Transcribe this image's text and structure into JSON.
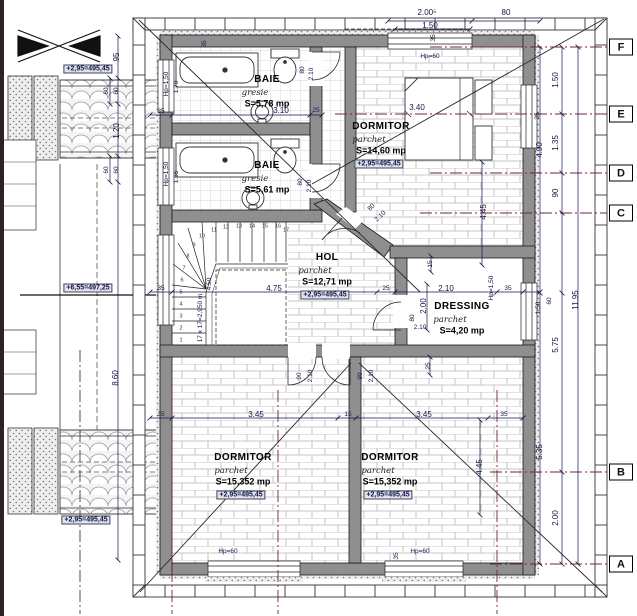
{
  "drawing": {
    "rooms": [
      {
        "id": "baie-1",
        "name": "BAIE",
        "finish": "gresie",
        "area": "S=5,78 mp",
        "x": 267,
        "y": 80
      },
      {
        "id": "baie-2",
        "name": "BAIE",
        "finish": "gresie",
        "area": "S=5,61 mp",
        "x": 267,
        "y": 166
      },
      {
        "id": "dormitor-top",
        "name": "DORMITOR",
        "finish": "parchet",
        "area": "S=14,60 mp",
        "level": "+2,95=495,45",
        "x": 381,
        "y": 127
      },
      {
        "id": "hol",
        "name": "HOL",
        "finish": "parchet",
        "area": "S=12,71 mp",
        "level": "+2,95=495,45",
        "x": 327,
        "y": 258
      },
      {
        "id": "dressing",
        "name": "DRESSING",
        "finish": "parchet",
        "area": "S=4,20 mp",
        "x": 462,
        "y": 307
      },
      {
        "id": "dormitor-left",
        "name": "DORMITOR",
        "finish": "parchet",
        "area": "S=15,352 mp",
        "level": "+2,95=495,45",
        "x": 243,
        "y": 458
      },
      {
        "id": "dormitor-right",
        "name": "DORMITOR",
        "finish": "parchet",
        "area": "S=15,352 mp",
        "level": "+2,95=495,45",
        "x": 390,
        "y": 458
      }
    ],
    "stairs": {
      "note": "17 x 17=2,950 m",
      "steps": [
        {
          "n": "1",
          "x": 181,
          "y": 341
        },
        {
          "n": "2",
          "x": 181,
          "y": 329
        },
        {
          "n": "3",
          "x": 181,
          "y": 317
        },
        {
          "n": "4",
          "x": 181,
          "y": 305
        },
        {
          "n": "5",
          "x": 181,
          "y": 293
        },
        {
          "n": "6",
          "x": 182,
          "y": 281
        },
        {
          "n": "7",
          "x": 184,
          "y": 269
        },
        {
          "n": "8",
          "x": 188,
          "y": 257
        },
        {
          "n": "9",
          "x": 194,
          "y": 246
        },
        {
          "n": "10",
          "x": 202,
          "y": 237
        },
        {
          "n": "11",
          "x": 214,
          "y": 231
        },
        {
          "n": "12",
          "x": 226,
          "y": 228
        },
        {
          "n": "13",
          "x": 239,
          "y": 227
        },
        {
          "n": "14",
          "x": 252,
          "y": 227
        },
        {
          "n": "15",
          "x": 265,
          "y": 227
        },
        {
          "n": "16",
          "x": 278,
          "y": 227
        },
        {
          "n": "17",
          "x": 286,
          "y": 231
        }
      ]
    },
    "grid_axes": [
      {
        "label": "F",
        "y": 47
      },
      {
        "label": "E",
        "y": 114
      },
      {
        "label": "D",
        "y": 173
      },
      {
        "label": "C",
        "y": 213
      },
      {
        "label": "B",
        "y": 472
      },
      {
        "label": "A",
        "y": 564
      }
    ],
    "labels": [
      {
        "t": "2.00⁵",
        "x": 427,
        "y": 13,
        "c": "dim",
        "n": "dim-top-200"
      },
      {
        "t": "80",
        "x": 506,
        "y": 13,
        "c": "dim",
        "n": "dim-top-80"
      },
      {
        "t": "1.50",
        "x": 430,
        "y": 26,
        "c": "dim",
        "n": "dim-top-150"
      },
      {
        "t": "35",
        "x": 434,
        "y": 38,
        "r": -90,
        "c": "dim7",
        "n": "dim-top-35"
      },
      {
        "t": "Hp=60",
        "x": 430,
        "y": 57,
        "c": "dim7",
        "n": "parapet-top-window"
      },
      {
        "t": "35",
        "x": 205,
        "y": 44,
        "r": -90,
        "c": "dim7",
        "n": "dim-topwall-35"
      },
      {
        "t": "95",
        "x": 117,
        "y": 57,
        "r": -90,
        "c": "dim",
        "n": "dim-left-95"
      },
      {
        "t": "60",
        "x": 107,
        "y": 91,
        "r": -90,
        "c": "dim7",
        "n": "dim-left-60a"
      },
      {
        "t": "60",
        "x": 117,
        "y": 91,
        "r": -90,
        "c": "dim7",
        "n": "dim-left-60b"
      },
      {
        "t": "1.20",
        "x": 117,
        "y": 131,
        "r": -90,
        "c": "dim",
        "n": "dim-left-120"
      },
      {
        "t": "60",
        "x": 107,
        "y": 170,
        "r": -90,
        "c": "dim7",
        "n": "dim-left-60c"
      },
      {
        "t": "60",
        "x": 117,
        "y": 170,
        "r": -90,
        "c": "dim7",
        "n": "dim-left-60d"
      },
      {
        "t": "8.60",
        "x": 116,
        "y": 378,
        "r": -90,
        "c": "dim",
        "n": "dim-left-860"
      },
      {
        "t": "+2,95=495,45",
        "x": 88,
        "y": 69,
        "c": "lvl",
        "n": "level-left-top"
      },
      {
        "t": "+6,55=497,25",
        "x": 88,
        "y": 288,
        "c": "lvl",
        "n": "level-left-mid"
      },
      {
        "t": "+2,95=495,45",
        "x": 86,
        "y": 520,
        "c": "lvl",
        "n": "level-left-bottom"
      },
      {
        "t": "Hp=1,50",
        "x": 167,
        "y": 84,
        "r": -90,
        "c": "dim7",
        "n": "parapet-baie1-window"
      },
      {
        "t": "1.70",
        "x": 177,
        "y": 87,
        "r": -90,
        "c": "dim7",
        "n": "dim-win-170"
      },
      {
        "t": "Hp=1,50",
        "x": 167,
        "y": 174,
        "r": -90,
        "c": "dim7",
        "n": "parapet-baie2-window"
      },
      {
        "t": "1.65",
        "x": 177,
        "y": 177,
        "r": -90,
        "c": "dim7",
        "n": "dim-win-165"
      },
      {
        "t": "35",
        "x": 161,
        "y": 112,
        "c": "dim7",
        "n": "dim-baie-35"
      },
      {
        "t": "3.10",
        "x": 281,
        "y": 111,
        "c": "dim",
        "n": "dim-baie-310"
      },
      {
        "t": "25",
        "x": 316,
        "y": 111,
        "c": "dim7",
        "n": "dim-baie-25"
      },
      {
        "t": "80",
        "x": 303,
        "y": 70,
        "r": -90,
        "c": "dim7",
        "n": "door-baie1-80"
      },
      {
        "t": "2.10",
        "x": 312,
        "y": 74,
        "r": -90,
        "c": "dim7",
        "n": "door-baie1-210"
      },
      {
        "t": "80",
        "x": 301,
        "y": 182,
        "r": -90,
        "c": "dim7",
        "n": "door-baie2-80"
      },
      {
        "t": "2.10",
        "x": 310,
        "y": 186,
        "r": -90,
        "c": "dim7",
        "n": "door-baie2-210"
      },
      {
        "t": "3.40",
        "x": 417,
        "y": 108,
        "c": "dim",
        "n": "dim-bed-340"
      },
      {
        "t": "4.45",
        "x": 484,
        "y": 212,
        "r": -90,
        "c": "dim",
        "n": "dim-dorm-445"
      },
      {
        "t": "35",
        "x": 538,
        "y": 116,
        "r": -90,
        "c": "dim7",
        "n": "dim-rightwall-35"
      },
      {
        "t": "80",
        "x": 372,
        "y": 208,
        "r": -45,
        "c": "dim7",
        "n": "door-diag-80"
      },
      {
        "t": "2.10",
        "x": 381,
        "y": 217,
        "r": -45,
        "c": "dim7",
        "n": "door-diag-210"
      },
      {
        "t": "4.75",
        "x": 274,
        "y": 289,
        "c": "dim",
        "n": "dim-hol-475"
      },
      {
        "t": "35",
        "x": 161,
        "y": 289,
        "c": "dim7",
        "n": "dim-hol-35l"
      },
      {
        "t": "25",
        "x": 386,
        "y": 289,
        "c": "dim7",
        "n": "dim-hol-25"
      },
      {
        "t": "2.10",
        "x": 446,
        "y": 289,
        "c": "dim",
        "n": "dim-dressing-210"
      },
      {
        "t": "35",
        "x": 508,
        "y": 289,
        "c": "dim7",
        "n": "dim-hol-35r"
      },
      {
        "t": "15",
        "x": 431,
        "y": 264,
        "r": -90,
        "c": "dim7",
        "n": "dim-dressing-15"
      },
      {
        "t": "2.00",
        "x": 424,
        "y": 306,
        "r": -90,
        "c": "dim",
        "n": "dim-dressing-200"
      },
      {
        "t": "Hp=1,50",
        "x": 492,
        "y": 288,
        "r": -90,
        "c": "dim7",
        "n": "parapet-dressing-window"
      },
      {
        "t": "25",
        "x": 429,
        "y": 366,
        "r": -90,
        "c": "dim7",
        "n": "dim-dressing-25"
      },
      {
        "t": "80",
        "x": 413,
        "y": 318,
        "r": -90,
        "c": "dim7",
        "n": "door-dressing-80"
      },
      {
        "t": "2.10",
        "x": 420,
        "y": 328,
        "c": "dim7",
        "n": "door-dressing-210"
      },
      {
        "t": "90",
        "x": 300,
        "y": 376,
        "r": -90,
        "c": "dim7",
        "n": "door-bedl-90"
      },
      {
        "t": "2.10",
        "x": 311,
        "y": 376,
        "r": -90,
        "c": "dim7",
        "n": "door-bedl-210"
      },
      {
        "t": "90",
        "x": 361,
        "y": 376,
        "r": -90,
        "c": "dim7",
        "n": "door-bedr-90"
      },
      {
        "t": "2.10",
        "x": 372,
        "y": 376,
        "r": -90,
        "c": "dim7",
        "n": "door-bedr-210"
      },
      {
        "t": "4.50",
        "x": 210,
        "y": 284,
        "r": -90,
        "c": "dim7",
        "n": "dim-stair-450"
      },
      {
        "t": "35",
        "x": 161,
        "y": 415,
        "c": "dim7",
        "n": "dim-bed-35l"
      },
      {
        "t": "3.45",
        "x": 256,
        "y": 415,
        "c": "dim",
        "n": "dim-bed-345l"
      },
      {
        "t": "15",
        "x": 348,
        "y": 415,
        "c": "dim7",
        "n": "dim-bed-15"
      },
      {
        "t": "3.45",
        "x": 424,
        "y": 415,
        "c": "dim",
        "n": "dim-bed-345r"
      },
      {
        "t": "35",
        "x": 504,
        "y": 415,
        "c": "dim7",
        "n": "dim-bed-35r"
      },
      {
        "t": "Hp=60",
        "x": 228,
        "y": 552,
        "c": "dim7",
        "n": "parapet-bedl-window"
      },
      {
        "t": "Hp=60",
        "x": 420,
        "y": 552,
        "c": "dim7",
        "n": "parapet-bedr-window"
      },
      {
        "t": "35",
        "x": 397,
        "y": 556,
        "r": -90,
        "c": "dim7",
        "n": "dim-bottom-35"
      },
      {
        "t": "4.45",
        "x": 480,
        "y": 467,
        "r": -90,
        "c": "dim",
        "n": "dim-bedr-445"
      },
      {
        "t": "1.50",
        "x": 556,
        "y": 80,
        "r": -90,
        "c": "dim",
        "n": "dim-right-150a"
      },
      {
        "t": "1.35",
        "x": 556,
        "y": 143,
        "r": -90,
        "c": "dim",
        "n": "dim-right-135"
      },
      {
        "t": "90",
        "x": 556,
        "y": 193,
        "r": -90,
        "c": "dim",
        "n": "dim-right-90"
      },
      {
        "t": "4.90",
        "x": 540,
        "y": 150,
        "r": -90,
        "c": "dim",
        "n": "dim-right-490"
      },
      {
        "t": "1.50",
        "x": 539,
        "y": 308,
        "r": -90,
        "c": "dim7",
        "n": "dim-right-150b"
      },
      {
        "t": "60",
        "x": 550,
        "y": 301,
        "r": -90,
        "c": "dim7",
        "n": "dim-right-60"
      },
      {
        "t": "5.75",
        "x": 556,
        "y": 345,
        "r": -90,
        "c": "dim",
        "n": "dim-right-575"
      },
      {
        "t": "5.35",
        "x": 540,
        "y": 452,
        "r": -90,
        "c": "dim",
        "n": "dim-right-535"
      },
      {
        "t": "2.00",
        "x": 556,
        "y": 518,
        "r": -90,
        "c": "dim",
        "n": "dim-right-200"
      },
      {
        "t": "11.95",
        "x": 576,
        "y": 300,
        "r": -90,
        "c": "dim",
        "n": "dim-right-1195"
      }
    ],
    "colors": {
      "wall": "#8f8f8f",
      "grid_line": "#6e2639",
      "dim_text": "#15154a",
      "level_box_bg": "#dfe3ec"
    }
  }
}
